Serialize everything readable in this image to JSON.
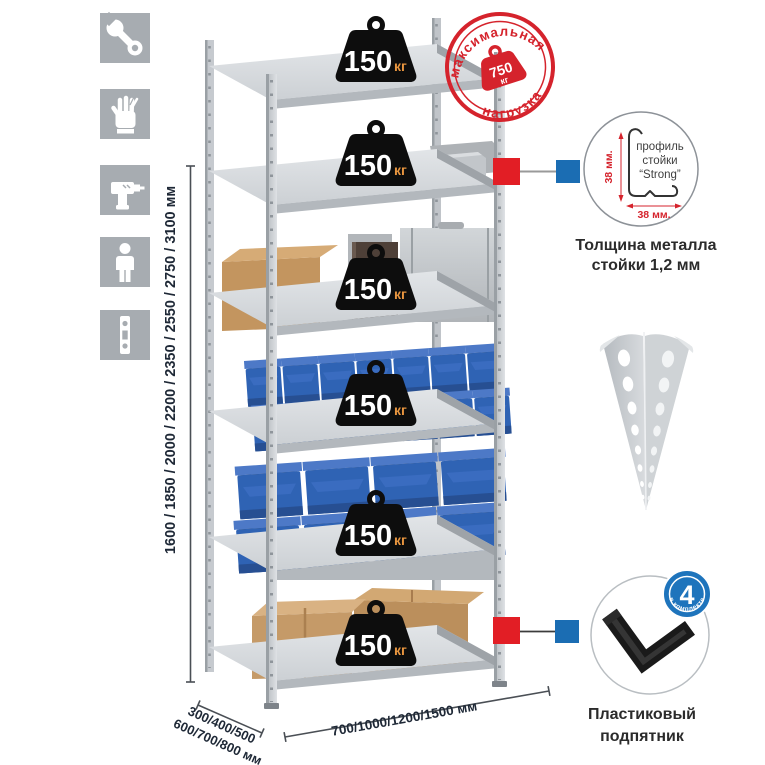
{
  "product": {
    "shelf_count": 6,
    "load_badge": {
      "value": "150",
      "unit": "кг"
    },
    "max_load_stamp": {
      "arc_top": "максимальная",
      "arc_bottom": "нагрузка",
      "value": "750",
      "unit": "кг"
    }
  },
  "dimensions": {
    "heights": "1600 / 1850 / 2000 / 2200 / 2350 / 2550 / 2750 / 3100 мм",
    "depths_line1": "300/400/500",
    "depths_line2": "600/700/800 мм",
    "widths": "700/1000/1200/1500 мм"
  },
  "callouts": {
    "profile": {
      "label_l1": "профиль",
      "label_l2": "стойки",
      "label_l3": "“Strong”",
      "dim_vertical": "38 мм.",
      "dim_horizontal": "38 мм.",
      "caption_l1": "Толщина металла",
      "caption_l2": "стойки 1,2 мм"
    },
    "foot": {
      "badge_value": "4",
      "badge_arc": "в комплекте",
      "caption_l1": "Пластиковый",
      "caption_l2": "подпятник"
    }
  },
  "assembly_icons": [
    "wrench",
    "gloves",
    "drill",
    "person",
    "upright-profile"
  ],
  "colors": {
    "stamp_red": "#d5232c",
    "callout_red": "#e21e25",
    "callout_blue": "#1b6db3",
    "bin_blue": "#2f63b4",
    "badge_black": "#0d0d0d",
    "badge_unit_orange": "#e8953f",
    "metal_gray": "#c6cacf",
    "icon_bg_gray": "#a7acb1",
    "cardboard_tan": "#c3955f"
  }
}
